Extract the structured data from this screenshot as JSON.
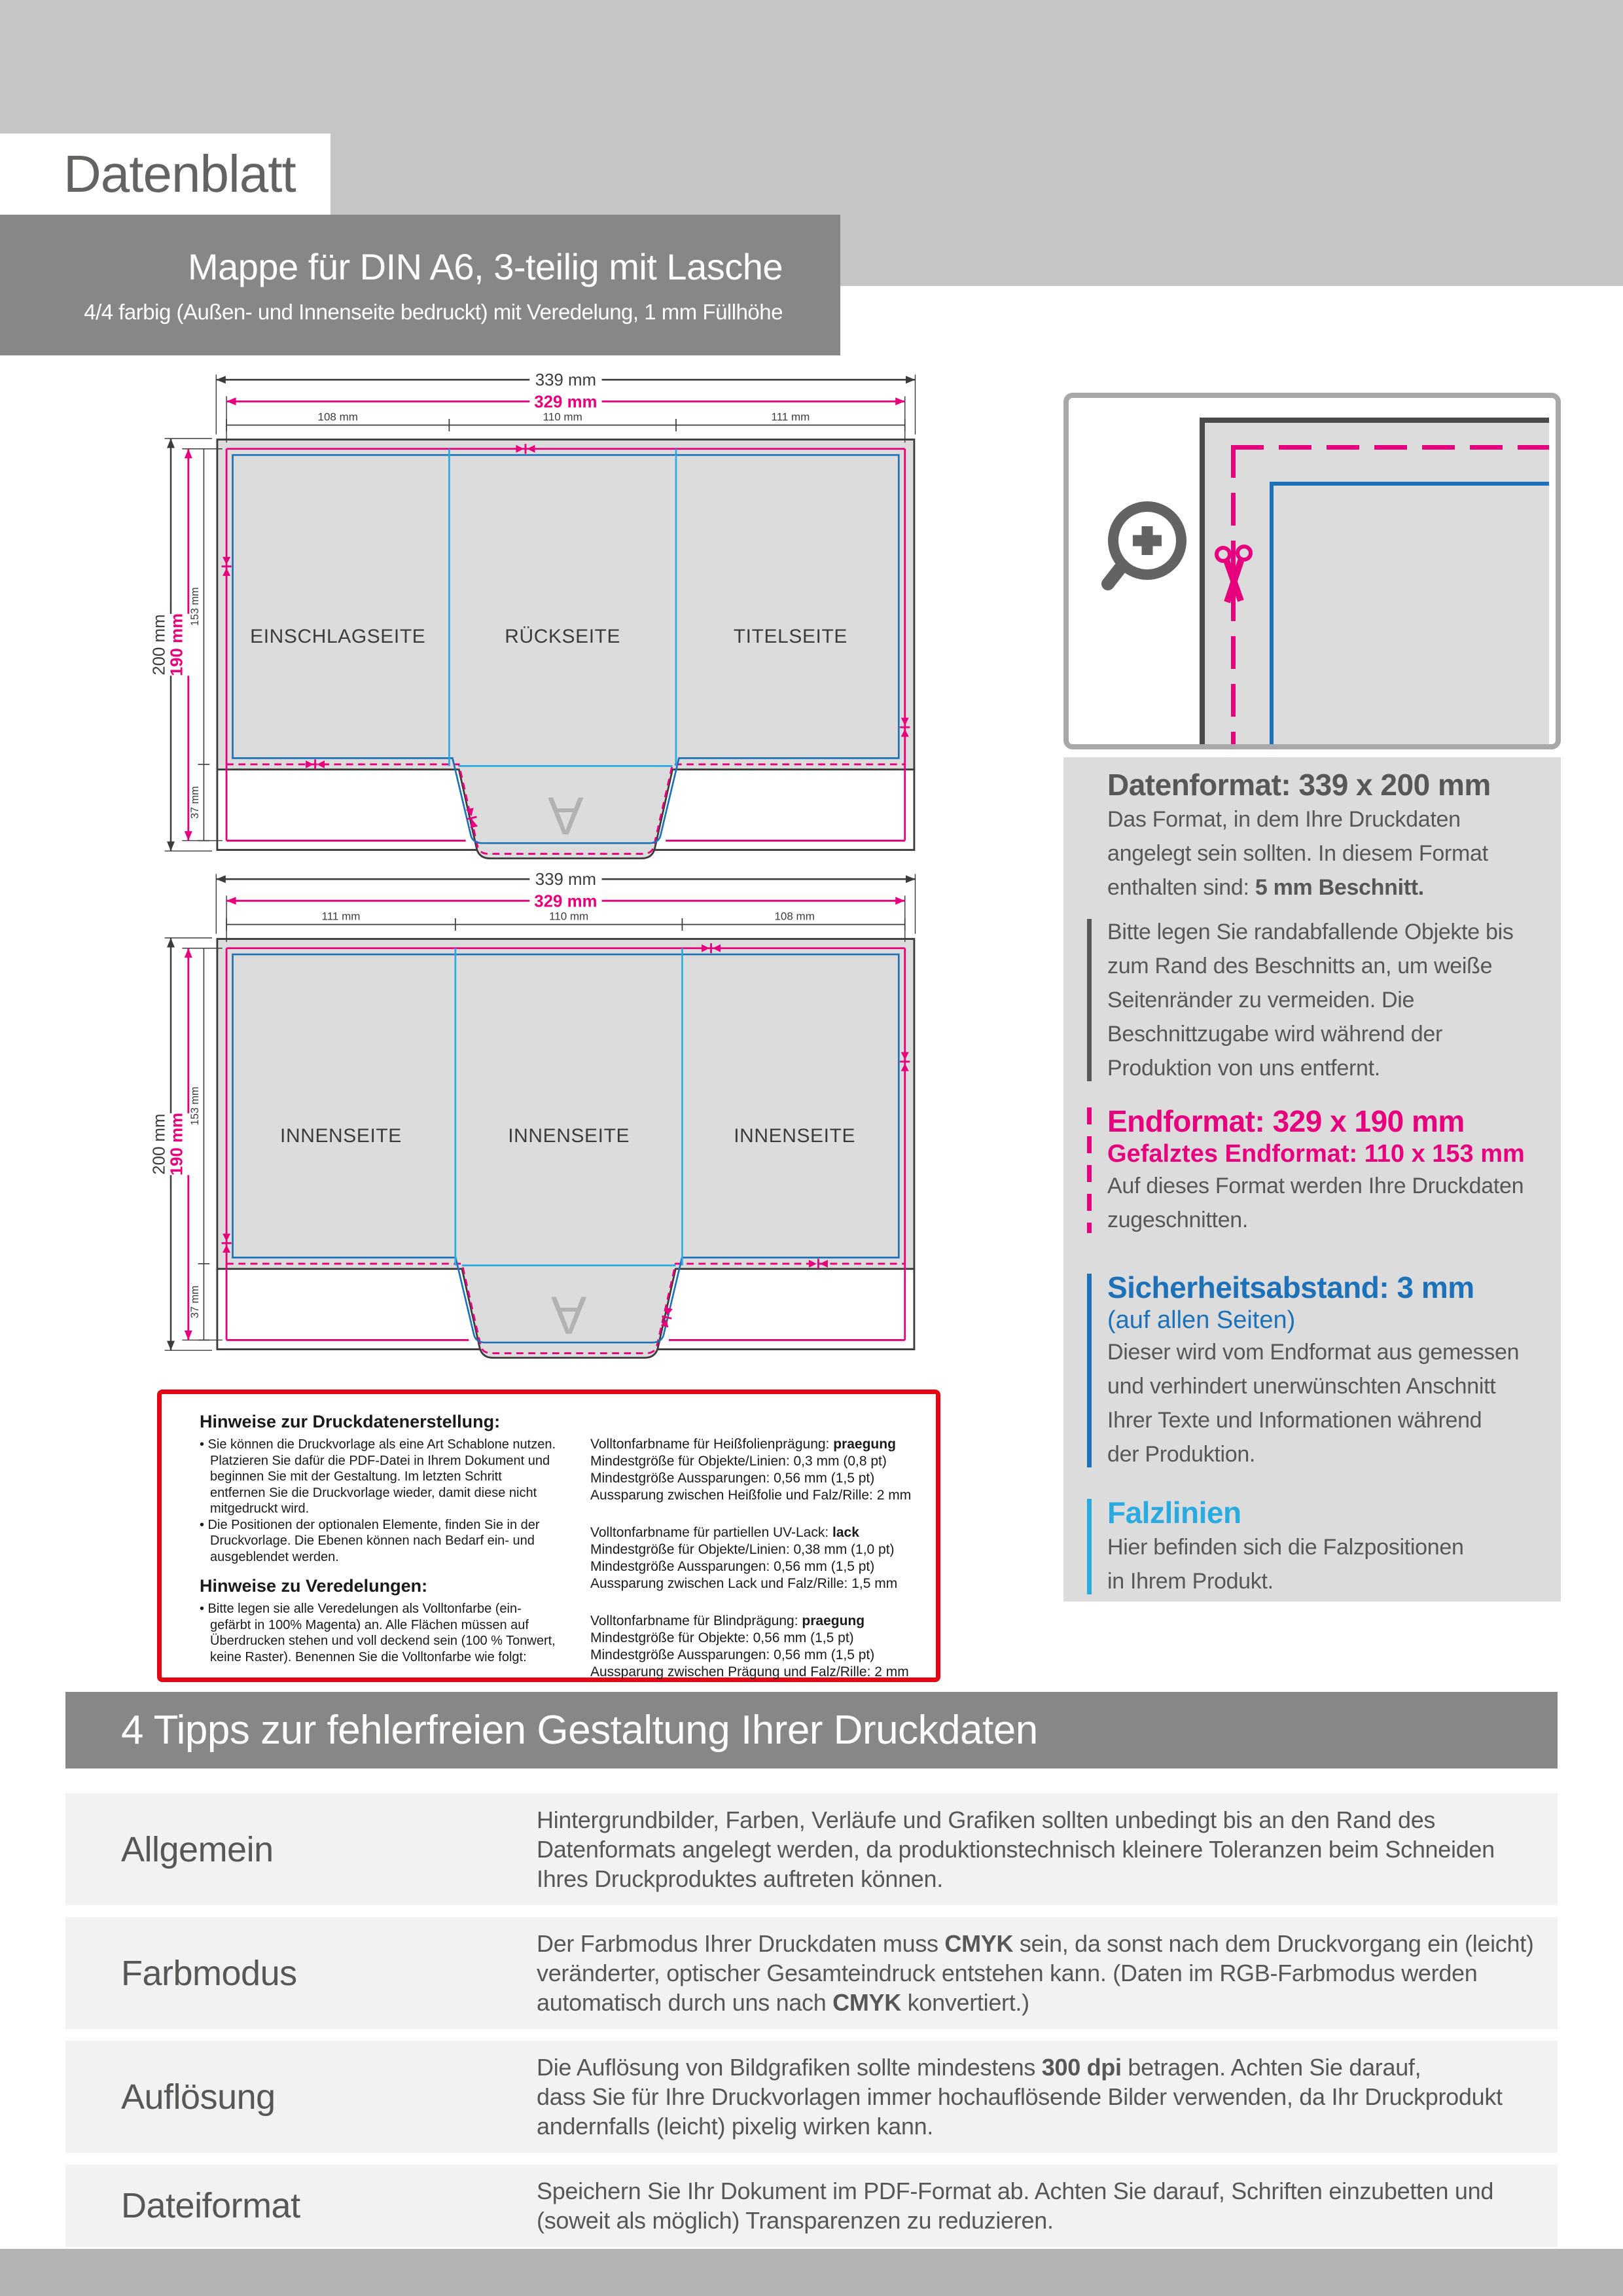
{
  "colors": {
    "magenta": "#e6007e",
    "blue": "#1d71b8",
    "cyan": "#29abe2",
    "red": "#e30613",
    "dark_text": "#575756",
    "line_dark": "#3c3c3b",
    "diagram_gray": "#dcdcdc",
    "header_gray": "#c6c6c5",
    "bar_gray": "#878786",
    "row_gray": "#f2f2f2",
    "footer_gray": "#b5b4b4"
  },
  "header": {
    "sheet_label": "Datenblatt",
    "product_title": "Mappe für DIN A6, 3-teilig mit Lasche",
    "product_subtitle": "4/4 farbig (Außen- und Innenseite bedruckt) mit Veredelung, 1 mm Füllhöhe"
  },
  "diagram_top": {
    "total_width": "339 mm",
    "end_width": "329 mm",
    "col_widths": [
      "108 mm",
      "110 mm",
      "111 mm"
    ],
    "total_height": "200 mm",
    "end_height": "190 mm",
    "panel_height": "153 mm",
    "flap_height": "37 mm",
    "panels": [
      "EINSCHLAGSEITE",
      "RÜCKSEITE",
      "TITELSEITE"
    ],
    "tab_letter": "A"
  },
  "diagram_bottom": {
    "total_width": "339 mm",
    "end_width": "329 mm",
    "col_widths": [
      "111 mm",
      "110 mm",
      "108 mm"
    ],
    "total_height": "200 mm",
    "end_height": "190 mm",
    "panel_height": "153 mm",
    "flap_height": "37 mm",
    "panels": [
      "INNENSEITE",
      "INNENSEITE",
      "INNENSEITE"
    ],
    "tab_letter": "A"
  },
  "info_panel": {
    "blocks": [
      {
        "style": "gray",
        "bar": "none",
        "heading": "Datenformat: 339 x 200 mm",
        "lines": [
          "Das Format, in dem Ihre Druckdaten",
          "angelegt sein sollten. In diesem Format",
          "enthalten sind: **5 mm Beschnitt.**"
        ]
      },
      {
        "style": "gray",
        "bar": "gray",
        "lines": [
          "Bitte legen Sie randabfallende Objekte bis",
          "zum Rand des Beschnitts an, um weiße",
          "Seitenränder zu vermeiden. Die",
          "Beschnittzugabe wird während der",
          "Produktion von uns entfernt."
        ]
      },
      {
        "style": "magenta",
        "bar": "magenta-dashed",
        "heading": "Endformat: 329 x 190 mm",
        "subheading": "Gefalztes Endformat: 110 x 153 mm",
        "subheading_bold": true,
        "lines": [
          "Auf dieses Format werden Ihre Druckdaten",
          "zugeschnitten."
        ]
      },
      {
        "style": "blue",
        "bar": "blue",
        "heading": "Sicherheitsabstand: 3 mm",
        "subheading": "(auf allen Seiten)",
        "subheading_bold": false,
        "lines": [
          "Dieser wird vom Endformat aus gemessen",
          "und verhindert unerwünschten Anschnitt",
          "Ihrer Texte und Informationen während",
          "der Produktion."
        ]
      },
      {
        "style": "cyan",
        "bar": "cyan",
        "heading": "Falzlinien",
        "lines": [
          "Hier befinden sich die Falzpositionen",
          "in Ihrem Produkt."
        ]
      }
    ]
  },
  "notes_box": {
    "left": [
      {
        "kind": "title",
        "text": "Hinweise zur Druckdatenerstellung:"
      },
      {
        "kind": "bullet",
        "lines": [
          "Sie können die Druckvorlage als eine Art Schablone nutzen.",
          "Platzieren Sie dafür die PDF-Datei in Ihrem Dokument und",
          "beginnen Sie mit der Gestaltung. Im letzten Schritt",
          "entfernen Sie die Druckvorlage wieder, damit diese nicht",
          "mitgedruckt wird."
        ]
      },
      {
        "kind": "bullet",
        "lines": [
          "Die Positionen der optionalen Elemente, finden Sie in der",
          "Druckvorlage. Die Ebenen können nach Bedarf ein- und",
          "ausgeblendet werden."
        ]
      },
      {
        "kind": "title",
        "text": "Hinweise zu Veredelungen:"
      },
      {
        "kind": "bullet",
        "lines": [
          "Bitte legen sie alle Veredelungen als Volltonfarbe (ein-",
          "gefärbt in 100% Magenta) an. Alle Flächen müssen auf",
          "Überdrucken stehen und voll deckend sein (100 % Tonwert,",
          "keine Raster). Benennen Sie die Volltonfarbe wie folgt:"
        ]
      }
    ],
    "right": [
      {
        "lines": [
          "Volltonfarbname für Heißfolienprägung: **praegung**",
          "Mindestgröße für Objekte/Linien: 0,3 mm (0,8 pt)",
          "Mindestgröße Aussparungen: 0,56 mm (1,5 pt)",
          "Aussparung zwischen Heißfolie und Falz/Rille: 2 mm"
        ]
      },
      {
        "lines": [
          "Volltonfarbname für partiellen UV-Lack: **lack**",
          "Mindestgröße für Objekte/Linien: 0,38 mm (1,0 pt)",
          "Mindestgröße Aussparungen: 0,56 mm (1,5 pt)",
          "Aussparung zwischen Lack und Falz/Rille: 1,5 mm"
        ]
      },
      {
        "lines": [
          "Volltonfarbname für Blindprägung: **praegung**",
          "Mindestgröße für Objekte: 0,56 mm (1,5 pt)",
          "Mindestgröße Aussparungen: 0,56 mm (1,5 pt)",
          "Aussparung zwischen Prägung und Falz/Rille: 2 mm"
        ]
      }
    ]
  },
  "tips": {
    "title": "4 Tipps zur fehlerfreien Gestaltung Ihrer Druckdaten",
    "rows": [
      {
        "label": "Allgemein",
        "lines": [
          "Hintergrundbilder, Farben, Verläufe und Grafiken sollten unbedingt bis an den Rand des",
          "Datenformats angelegt werden, da produktionstechnisch kleinere Toleranzen beim Schneiden",
          "Ihres Druckproduktes auftreten können."
        ]
      },
      {
        "label": "Farbmodus",
        "lines": [
          "Der Farbmodus Ihrer Druckdaten muss **CMYK** sein, da sonst nach dem Druckvorgang ein (leicht)",
          "veränderter, optischer Gesamteindruck entstehen kann. (Daten im RGB-Farbmodus werden",
          "automatisch durch uns nach **CMYK** konvertiert.)"
        ]
      },
      {
        "label": "Auflösung",
        "lines": [
          "Die Auflösung von Bildgrafiken sollte mindestens **300 dpi** betragen. Achten Sie darauf,",
          "dass Sie für Ihre Druckvorlagen immer hochauflösende Bilder verwenden, da Ihr Druckprodukt",
          "andernfalls (leicht) pixelig wirken kann."
        ]
      },
      {
        "label": "Dateiformat",
        "lines": [
          "Speichern Sie Ihr Dokument im PDF-Format ab. Achten Sie darauf, Schriften einzubetten und",
          "(soweit als möglich) Transparenzen zu reduzieren."
        ]
      }
    ]
  }
}
